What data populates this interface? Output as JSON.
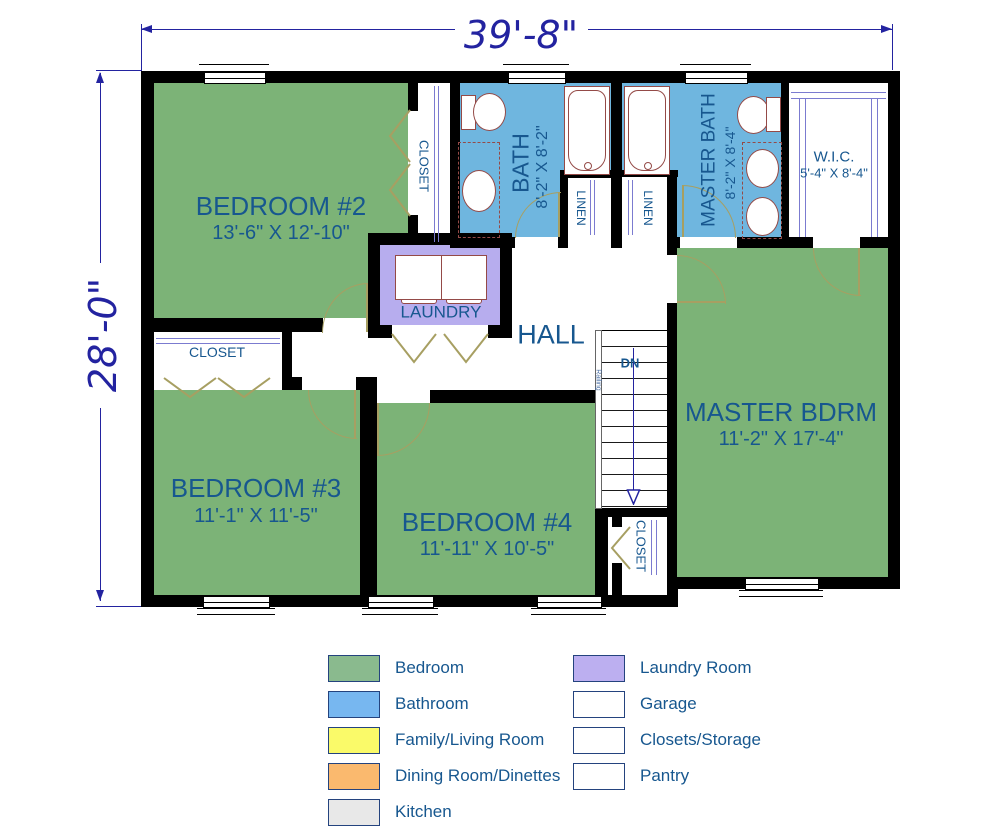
{
  "plan": {
    "dimensions": {
      "width": "39'-8\"",
      "height": "28'-0\""
    },
    "rooms": {
      "bedroom2": {
        "name": "BEDROOM #2",
        "dims": "13'-6\" X 12'-10\""
      },
      "bedroom3": {
        "name": "BEDROOM #3",
        "dims": "11'-1\" X 11'-5\""
      },
      "bedroom4": {
        "name": "BEDROOM #4",
        "dims": "11'-11\" X 10'-5\""
      },
      "master_bedroom": {
        "name": "MASTER BDRM",
        "dims": "11'-2\" X 17'-4\""
      },
      "bath": {
        "name": "BATH",
        "dims": "8'-2\" X 8'-2\""
      },
      "master_bath": {
        "name": "MASTER BATH",
        "dims": "8'-2\" X 8'-4\""
      },
      "wic": {
        "name": "W.I.C.",
        "dims": "5'-4\" X 8'-4\""
      },
      "laundry": {
        "name": "LAUNDRY"
      },
      "hall": {
        "name": "HALL"
      }
    },
    "labels": {
      "closet": "CLOSET",
      "linen": "LINEN",
      "down": "DN",
      "railing": "Railing"
    }
  },
  "colors": {
    "bedroom": "#7CB377",
    "bathroom": "#6FB6DF",
    "laundry": "#B7ADEE",
    "wall": "#000000",
    "label_text": "#17578F",
    "dimension_text": "#2323A0",
    "door": "#A79F62",
    "fixture": "#944A47"
  },
  "legend": {
    "items": [
      {
        "label": "Bedroom",
        "color": "#8ABA8E"
      },
      {
        "label": "Bathroom",
        "color": "#77B7F0"
      },
      {
        "label": "Family/Living Room",
        "color": "#FAFA69"
      },
      {
        "label": "Dining Room/Dinettes",
        "color": "#FAB96E"
      },
      {
        "label": "Kitchen",
        "color": "#E8E8E8"
      },
      {
        "label": "Laundry Room",
        "color": "#BCAFF0"
      },
      {
        "label": "Garage",
        "color": "#FFFFFF"
      },
      {
        "label": "Closets/Storage",
        "color": "#FFFFFF"
      },
      {
        "label": "Pantry",
        "color": "#FFFFFF"
      }
    ]
  }
}
